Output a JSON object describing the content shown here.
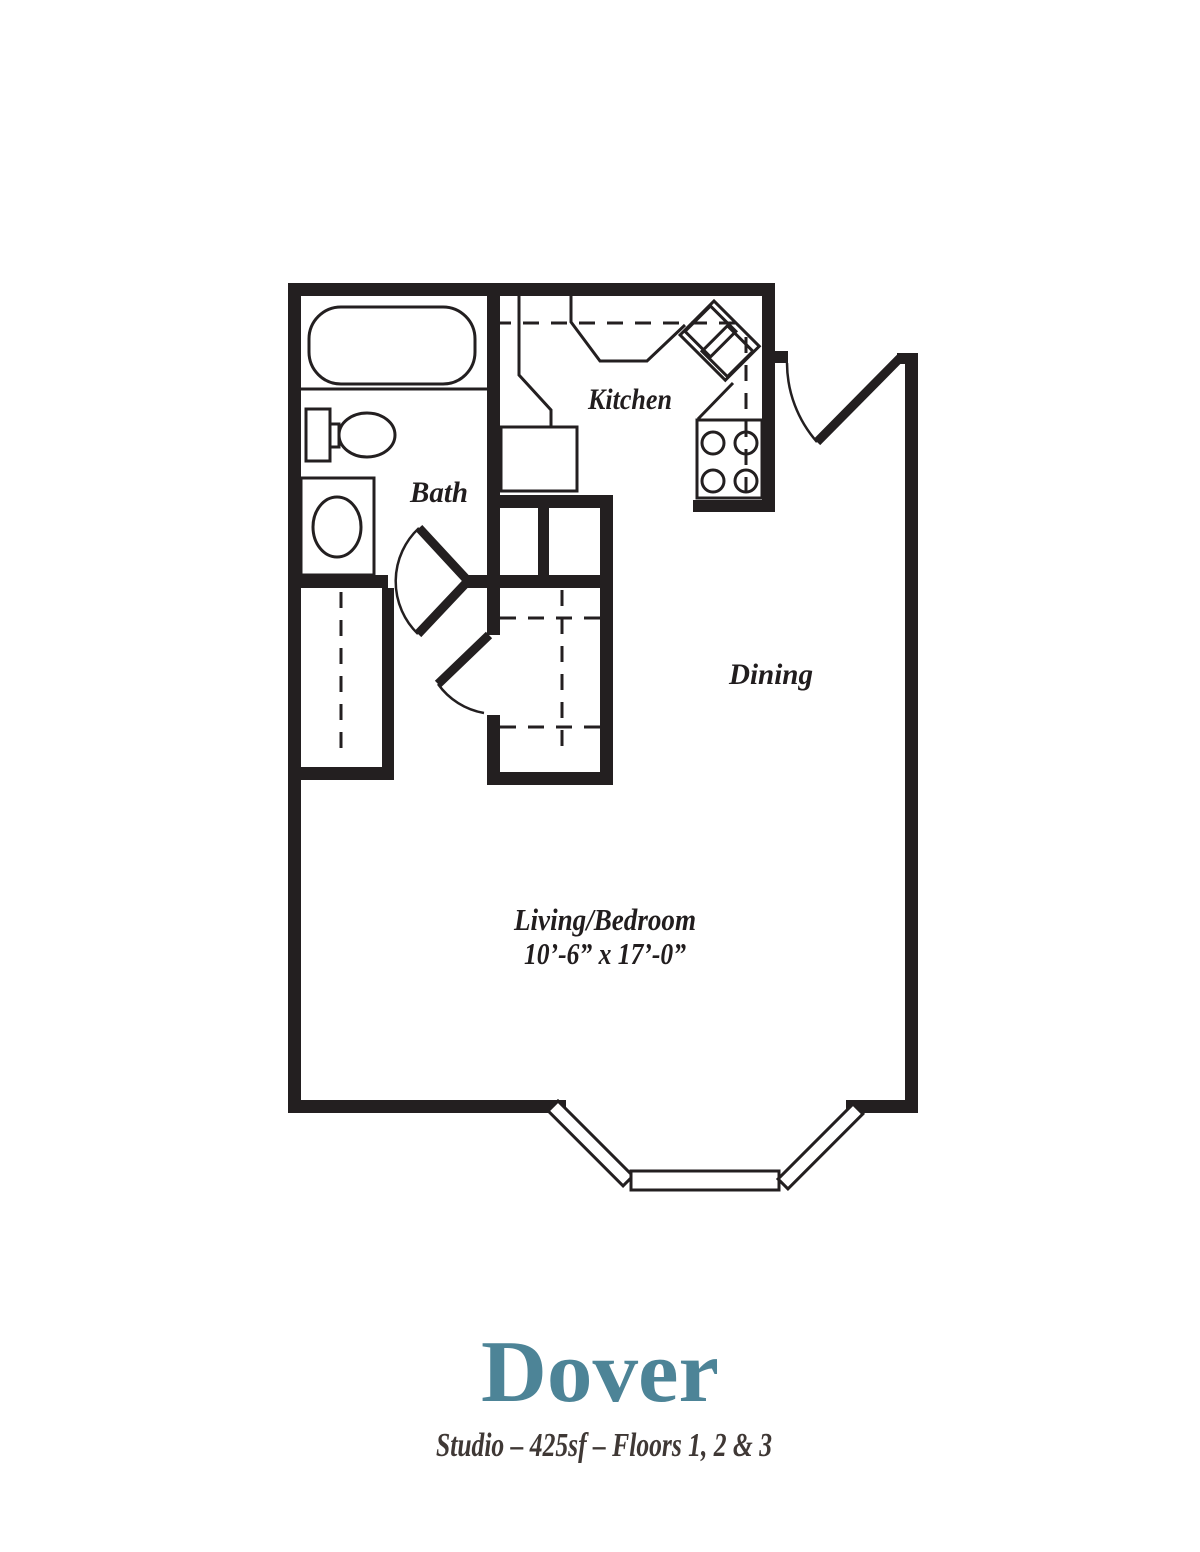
{
  "title": {
    "name": "Dover",
    "subtitle": "Studio – 425sf – Floors 1, 2 & 3"
  },
  "labels": {
    "kitchen": "Kitchen",
    "bath": "Bath",
    "dining": "Dining",
    "living_line1": "Living/Bedroom",
    "living_line2": "10’-6” x 17’-0”"
  },
  "colors": {
    "wall": "#231f20",
    "label": "#211d1e",
    "title": "#4d8497",
    "subtitle": "#3f3835",
    "background": "#ffffff"
  },
  "floorplan": {
    "unit_name": "Dover",
    "unit_type": "Studio",
    "area": "425sf",
    "floors": "Floors 1, 2 & 3",
    "living_dimensions": "10’-6” x 17’-0”",
    "rooms": [
      "Kitchen",
      "Bath",
      "Dining",
      "Living/Bedroom"
    ],
    "fixtures": [
      "bathtub",
      "toilet",
      "washer-dryer",
      "refrigerator",
      "corner-double-sink",
      "range-4-burner",
      "entry-door",
      "bath-door",
      "walk-in-closet",
      "left-closet",
      "bay-window"
    ]
  }
}
